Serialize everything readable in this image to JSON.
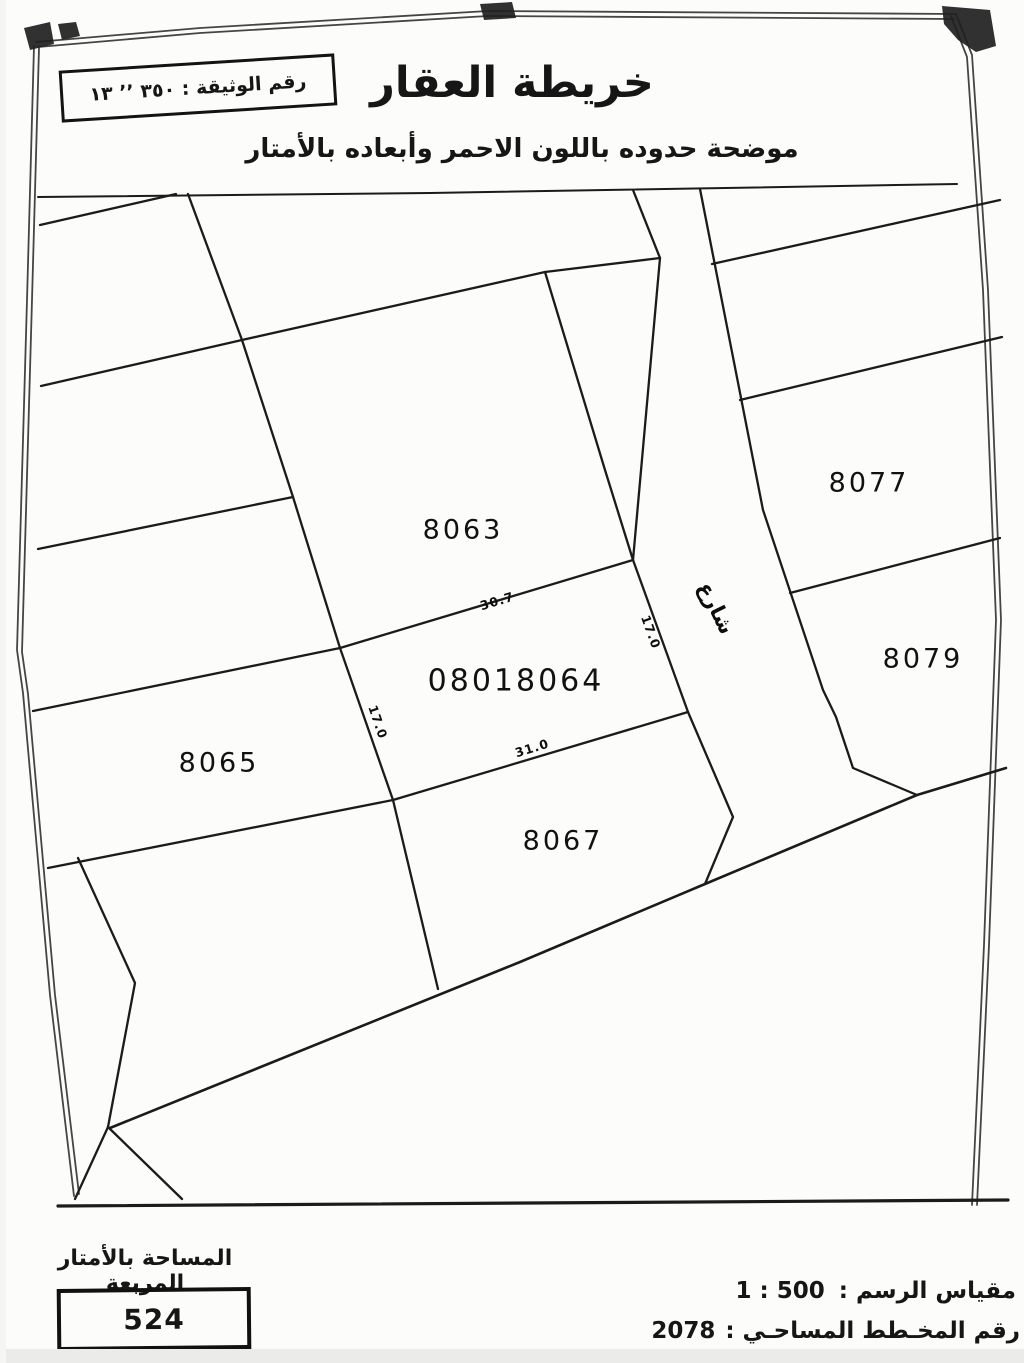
{
  "meta": {
    "document_kind": "scanned cadastral property map",
    "ink_color": "#1a1a1a",
    "paper_color": "#fcfcfa"
  },
  "header": {
    "doc_number": "رقم الوثيقة : ٣٥٠ ٬٬ ١٣",
    "title": "خريطة العقار",
    "subtitle": "موضحة حدوده باللون الاحمر وأبعاده بالأمتار"
  },
  "map": {
    "street_label": "شارع",
    "parcels": [
      {
        "id": "8063"
      },
      {
        "id": "08018064",
        "subject": true
      },
      {
        "id": "8065"
      },
      {
        "id": "8067"
      },
      {
        "id": "8077"
      },
      {
        "id": "8079"
      }
    ],
    "dimensions": [
      {
        "edge": "top",
        "value": "30.7"
      },
      {
        "edge": "right",
        "value": "17.0"
      },
      {
        "edge": "left",
        "value": "17.0"
      },
      {
        "edge": "bottom",
        "value": "31.0"
      }
    ]
  },
  "footer": {
    "area_label": "المساحة بالأمتار المربعة",
    "area_value": "524",
    "scale_label": "مقياس الرسم :",
    "scale_value": "1 : 500",
    "plan_label": "رقم المخـطط المساحـي :",
    "plan_value": "2078"
  }
}
